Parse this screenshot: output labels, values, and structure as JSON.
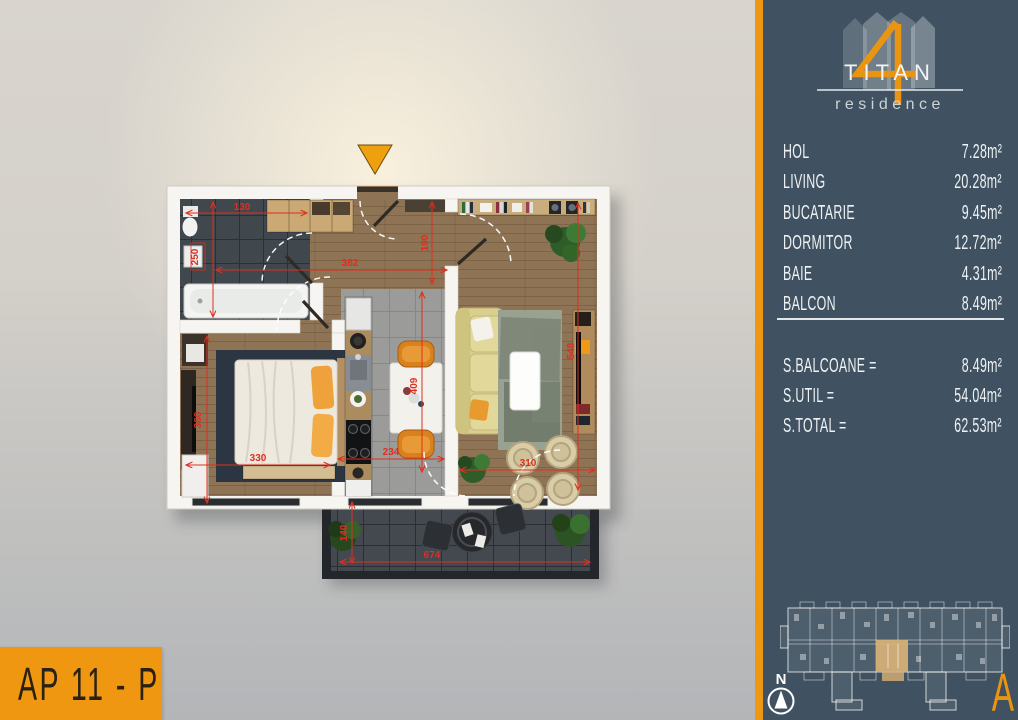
{
  "panel": {
    "logo": {
      "name": "TITAN",
      "subtitle": "residence"
    },
    "rooms": [
      {
        "label": "HOL",
        "area": "7.28m²"
      },
      {
        "label": "LIVING",
        "area": "20.28m²"
      },
      {
        "label": "BUCATARIE",
        "area": "9.45m²"
      },
      {
        "label": "DORMITOR",
        "area": "12.72m²"
      },
      {
        "label": "BAIE",
        "area": "4.31m²"
      },
      {
        "label": "BALCON",
        "area": "8.49m²"
      }
    ],
    "totals": [
      {
        "label": "S.BALCOANE =",
        "area": "8.49m²"
      },
      {
        "label": "S.UTIL =",
        "area": "54.04m²"
      },
      {
        "label": "S.TOTAL =",
        "area": "62.53m²"
      }
    ],
    "building_section": "A",
    "compass": "N"
  },
  "floorplan": {
    "apartment_label": "AP 11 - P",
    "dimensions": {
      "bath_width": "130",
      "bath_height": "250",
      "hall_width": "382",
      "hall_height": "190",
      "bedroom_width": "330",
      "bedroom_height": "360",
      "kitchen_width": "234",
      "kitchen_height": "409",
      "living_width": "310",
      "living_height": "548",
      "balcony_width": "674",
      "balcony_height": "140"
    }
  },
  "colors": {
    "accent": "#ee9712",
    "panel_bg": "#405261",
    "dimension_red": "#df2f20",
    "highlight_unit": "#d8b277"
  }
}
